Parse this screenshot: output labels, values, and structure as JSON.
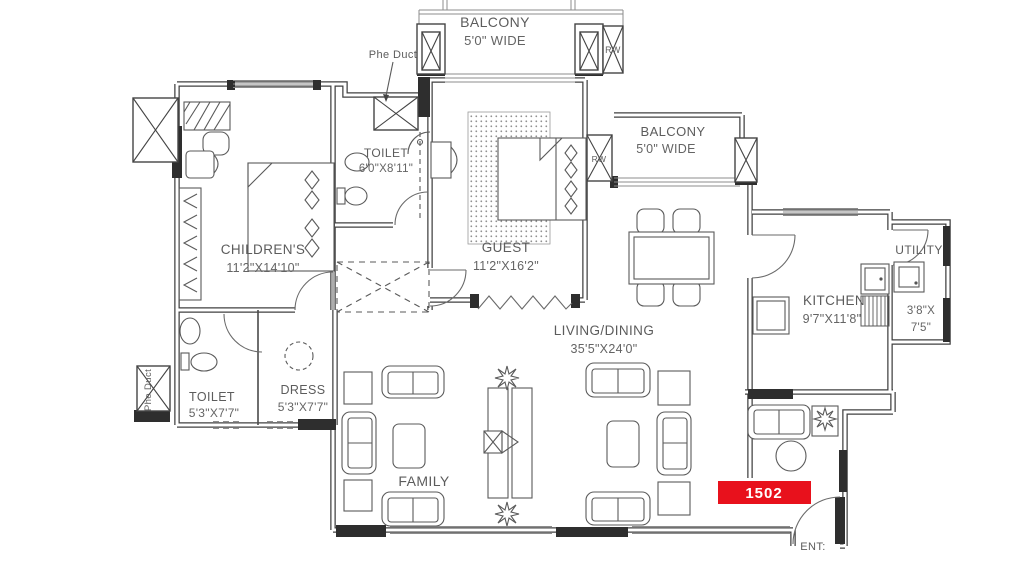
{
  "drawing": {
    "unit_number": "1502",
    "entry_label": "ENT:",
    "rooms": [
      {
        "id": "balcony-top",
        "label": "BALCONY",
        "dim": "5'0\" WIDE"
      },
      {
        "id": "toilet-top",
        "label": "TOILET",
        "dim": "6'0\"X8'11\""
      },
      {
        "id": "childrens",
        "label": "CHILDREN'S",
        "dim": "11'2\"X14'10\""
      },
      {
        "id": "guest",
        "label": "GUEST",
        "dim": "11'2\"X16'2\""
      },
      {
        "id": "balcony-right",
        "label": "BALCONY",
        "dim": "5'0\" WIDE"
      },
      {
        "id": "living-dining",
        "label": "LIVING/DINING",
        "dim": "35'5\"X24'0\""
      },
      {
        "id": "kitchen",
        "label": "KITCHEN",
        "dim": "9'7\"X11'8\""
      },
      {
        "id": "utility",
        "label": "UTILITY",
        "dim_lines": [
          "3'8\"X",
          "7'5\""
        ]
      },
      {
        "id": "toilet-bottom",
        "label": "TOILET",
        "dim": "5'3\"X7'7\""
      },
      {
        "id": "dress",
        "label": "DRESS",
        "dim": "5'3\"X7'7\""
      },
      {
        "id": "family",
        "label": "FAMILY"
      }
    ],
    "annotations": {
      "phe_duct": "Phe Duct",
      "rw": "RW"
    },
    "colors": {
      "badge_bg": "#e8111c",
      "badge_text": "#ffffff",
      "wall": "#3f3f3f",
      "label": "#5c5c5c"
    }
  }
}
